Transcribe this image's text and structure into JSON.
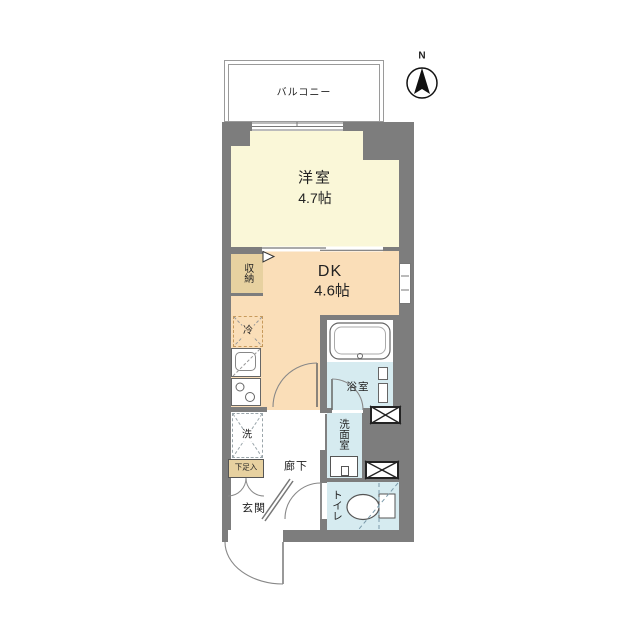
{
  "compass": {
    "north_label": "N"
  },
  "balcony": {
    "label": "バルコニー"
  },
  "rooms": {
    "western": {
      "name": "洋室",
      "size": "4.7帖"
    },
    "dk": {
      "name": "DK",
      "size": "4.6帖"
    },
    "storage": {
      "name": "収納"
    },
    "fridge": {
      "name": "冷"
    },
    "bath": {
      "name": "浴室"
    },
    "washroom": {
      "name": "洗面室"
    },
    "laundry": {
      "name": "洗"
    },
    "shoebox": {
      "name": "下足入"
    },
    "entrance": {
      "name": "玄関"
    },
    "corridor": {
      "name": "廊下"
    },
    "toilet": {
      "name": "トイレ"
    }
  },
  "colors": {
    "wall": "#7d7d7d",
    "western_room_fill": "#faf7d8",
    "dk_fill": "#fadeb8",
    "storage_fill": "#e7d1a0",
    "wet_area_fill": "#d6ebf0"
  }
}
